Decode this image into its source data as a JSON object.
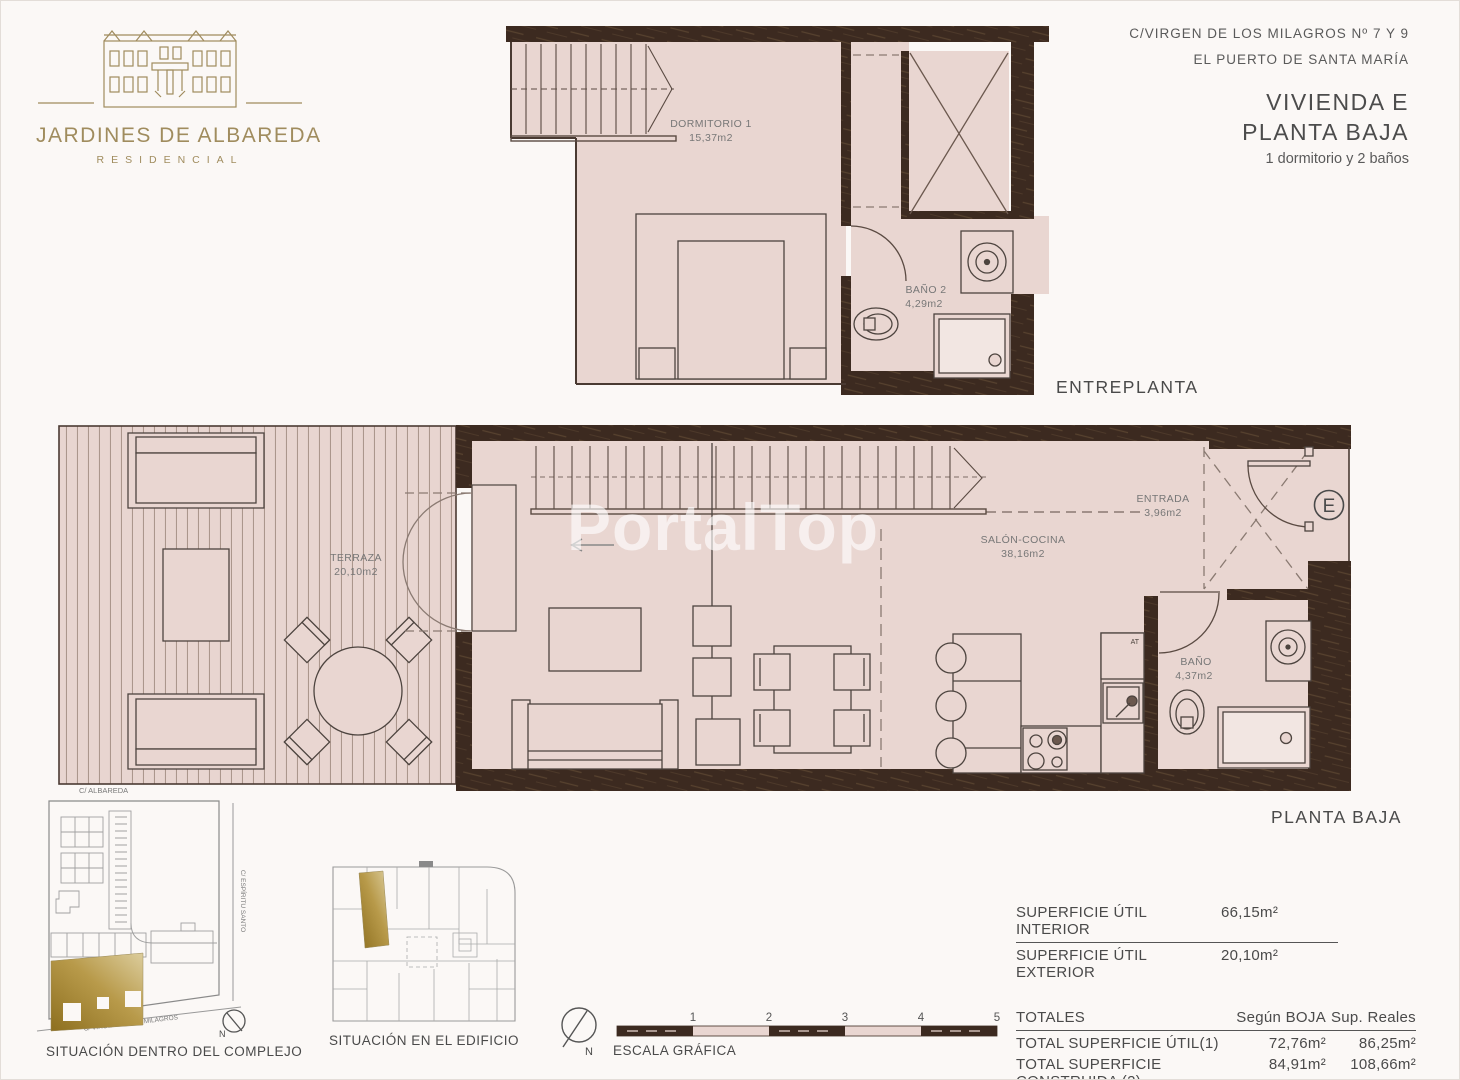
{
  "logo": {
    "title": "JARDINES DE ALBAREDA",
    "subtitle": "RESIDENCIAL"
  },
  "header": {
    "address_line1": "C/VIRGEN DE LOS MILAGROS Nº 7 Y 9",
    "address_line2": "EL PUERTO DE SANTA MARÍA",
    "unit": "VIVIENDA E",
    "floor": "PLANTA BAJA",
    "rooms_summary": "1 dormitorio y 2 baños"
  },
  "watermark": "PortalTop",
  "colors": {
    "wall": "#3c2a20",
    "floor": "#e9d6d1",
    "brand_gold": "#a08c5e",
    "highlight_gold": "#a5852e"
  },
  "entreplanta": {
    "label": "ENTREPLANTA",
    "dormitorio_name": "DORMITORIO 1",
    "dormitorio_area": "15,37m2",
    "bano_name": "BAÑO 2",
    "bano_area": "4,29m2"
  },
  "planta_baja": {
    "label": "PLANTA BAJA",
    "terraza_name": "TERRAZA",
    "terraza_area": "20,10m2",
    "salon_name": "SALÓN-COCINA",
    "salon_area": "38,16m2",
    "entrada_name": "ENTRADA",
    "entrada_area": "3,96m2",
    "bano_name": "BAÑO",
    "bano_area": "4,37m2",
    "entrance_mark": "E",
    "at_mark": "AT"
  },
  "site_complex": {
    "caption": "SITUACIÓN DENTRO DEL COMPLEJO",
    "street_top": "C/ ALBAREDA",
    "street_right": "C/ ESPÍRITU SANTO",
    "street_bottom": "C/ VIRGEN DE LOS MILAGROS",
    "north": "N"
  },
  "site_building": {
    "caption": "SITUACIÓN EN EL EDIFICIO"
  },
  "scale": {
    "caption": "ESCALA GRÁFICA",
    "north": "N",
    "ticks": [
      "1",
      "2",
      "3",
      "4",
      "5"
    ]
  },
  "areas": {
    "util_interior_label": "SUPERFICIE ÚTIL INTERIOR",
    "util_interior_value": "66,15m²",
    "util_exterior_label": "SUPERFICIE ÚTIL EXTERIOR",
    "util_exterior_value": "20,10m²",
    "totals_label": "TOTALES",
    "col_boja": "Según BOJA",
    "col_reales": "Sup. Reales",
    "total_util_label": "TOTAL SUPERFICIE ÚTIL(1)",
    "total_util_boja": "72,76m²",
    "total_util_reales": "86,25m²",
    "total_construida_label": "TOTAL SUPERFICIE CONSTRUIDA  (2)",
    "total_construida_boja": "84,91m²",
    "total_construida_reales": "108,66m²"
  }
}
